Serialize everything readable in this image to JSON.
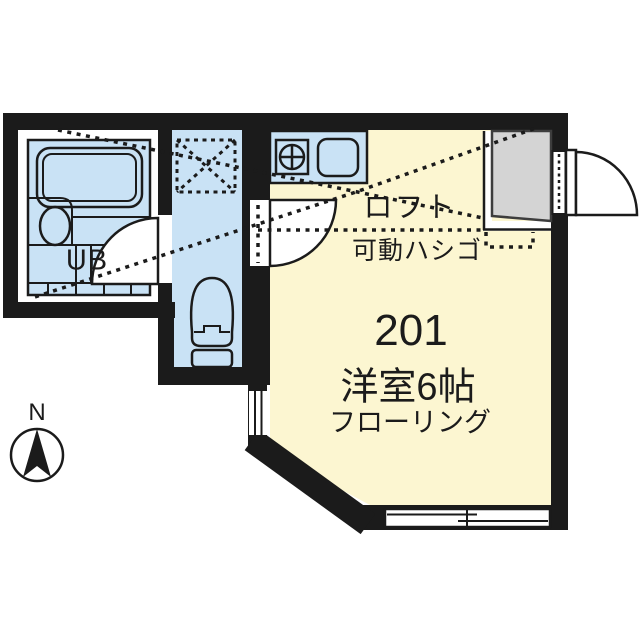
{
  "floor_plan": {
    "unit_number": "201",
    "main_room": {
      "type_label": "洋室6帖",
      "finish_label": "フローリング"
    },
    "loft": {
      "label": "ロフト",
      "ladder_label": "可動ハシゴ"
    },
    "bath_label": "UB",
    "compass_north_label": "N",
    "colors": {
      "wall": "#1b1b1b",
      "wet_area_blue": "#c9e2f5",
      "living_area_cream": "#fcf6d1",
      "entry_gray": "#d4d4d4",
      "background": "#ffffff"
    }
  }
}
